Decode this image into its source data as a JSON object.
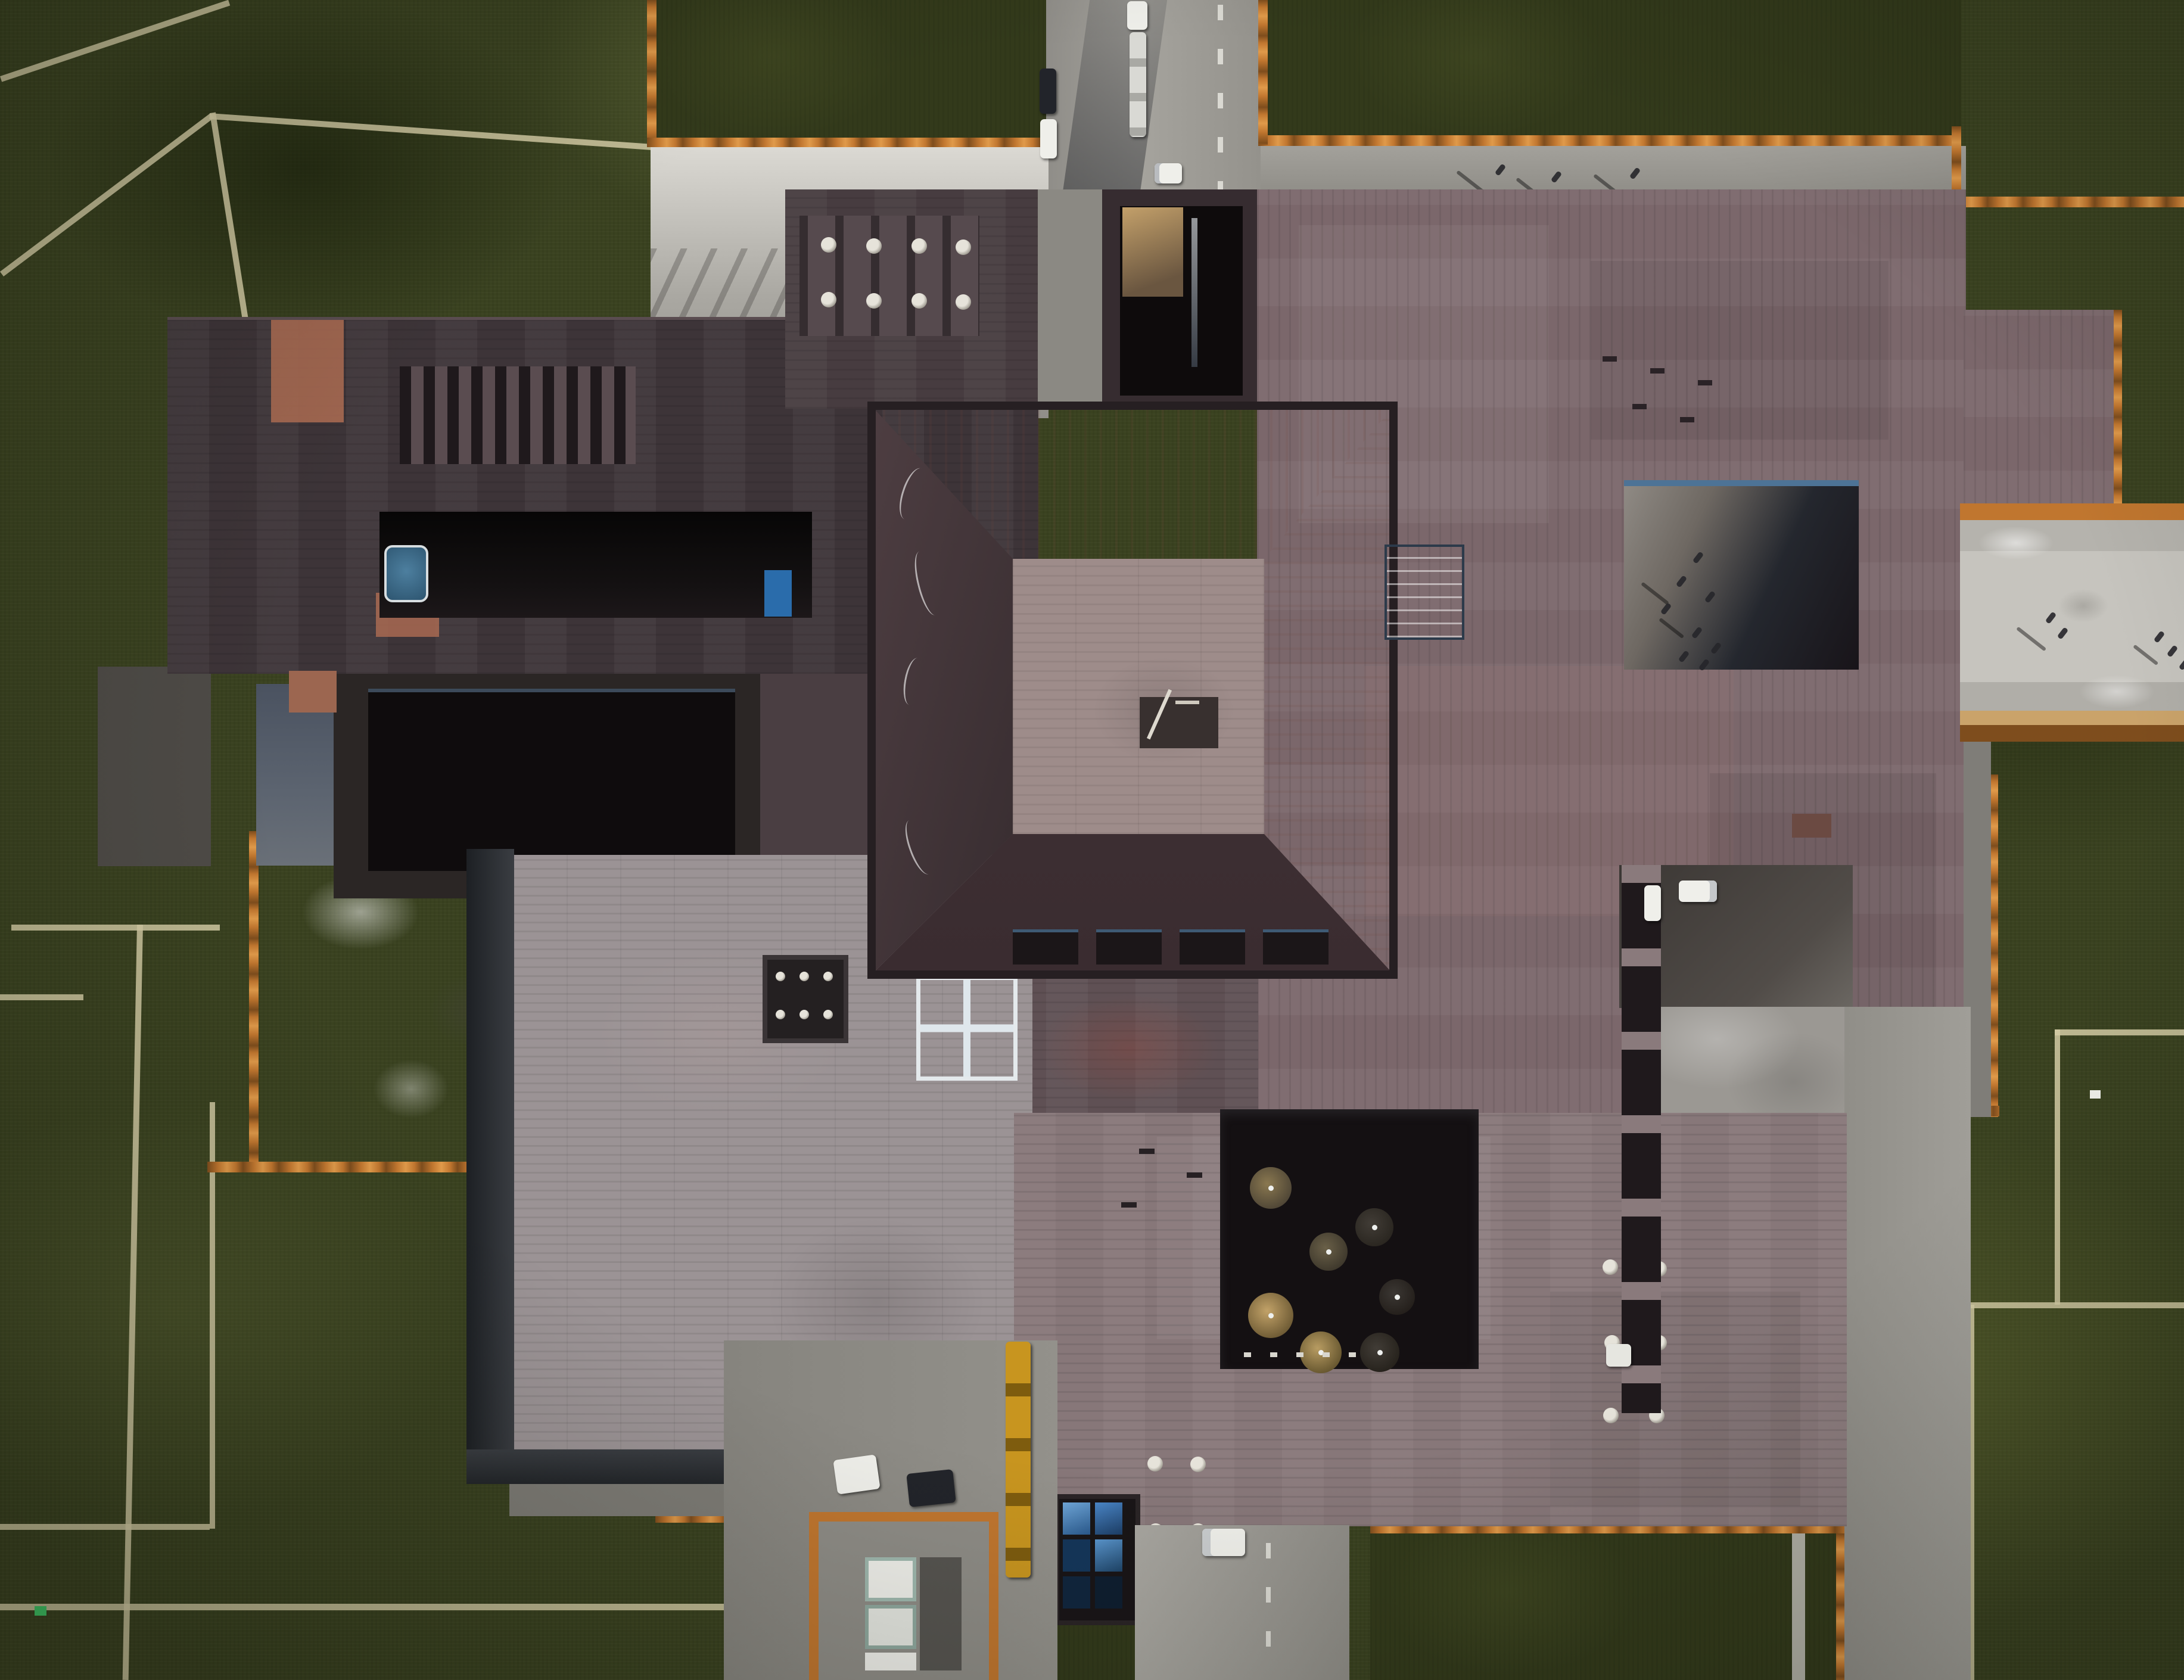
{
  "meta": {
    "description": "Top-down aerial drone photograph of a large museum-style building complex under afternoon light with long shadows",
    "view": "nadir (directly overhead)",
    "setting": "building complex surrounded by olive-green lawns divided by pale paths"
  },
  "palette": {
    "grass": "#3a4220",
    "grassPlot": "#333a1b",
    "grassLine": "#d3cba4",
    "concrete": "#9b9893",
    "concreteLight": "#c9c7c0",
    "concreteWeathered": "#dbd9d3",
    "concreteShadow": "#4e4b47",
    "concreteDark": "#7d7b75",
    "rust": "#c0762f",
    "rustLight": "#e09a4a",
    "rustDark": "#7e4d1d",
    "wing": "#3d3438",
    "wingLight": "#5a4c50",
    "slotDark": "#1f191c",
    "blockA": "#473c40",
    "blockB": "#362c30",
    "roofMain": "#7b676b",
    "roofGray": "#9b9395",
    "roofGray2": "#877779",
    "roofBelow": "#5f5054",
    "pavTop": "#d2a497",
    "pavTopLight": "#e0b6a8",
    "pavRight": "#c2a49a",
    "pavLeft": "#4e3e42",
    "pavDark": "#443438",
    "pavFlat": "#9e8c8a",
    "frame": "#261f22",
    "skyBlue": "#3f8fd2",
    "skyBlueLight": "#85b9e4",
    "skyBlueDark": "#2a6cab",
    "courtDark": "#141012",
    "courtMid": "#2b2625",
    "treeTan": "#c2a268",
    "treeOlive": "#8a7850",
    "treeDark": "#413c36",
    "terracotta": "#a96a52",
    "terracottaDark": "#8a5c50",
    "white": "#efefea",
    "carDark": "#22242a",
    "truckYellow": "#c8951f",
    "person": "#26262a",
    "steelBlue": "#5c6470",
    "poolBlack": "#0f0c0d",
    "litWall": "#c3a06a",
    "signGreen": "#3ec264"
  },
  "scene": {
    "building": {
      "central_pavilion": "square hipped roof, salmon-pink sunlit north slope, dark shaded slopes, flat mauve center with small hatch opening, four dark skylights on south slope",
      "left_wing": "dark charcoal bar with row of slot windows, recessed black entrance strip, terracotta accent patches",
      "main_east_roof": "large mauve-brown roof with sunken light-well courtyard and vent marks",
      "south_roof": "gray-mauve roof with sunken tree courtyard, round vents and glazed skylight grid",
      "west_roof": "light gray plank-textured roof with dark skylight box and blue glazed skylight"
    },
    "skylights_blue": 3,
    "courtyard_trees": 7,
    "orange_curbs": "weathered corten-steel edging around lawns and roof plots",
    "vehicles": [
      {
        "kind": "dark-car",
        "location": "north road"
      },
      {
        "kind": "white-car",
        "location": "north road"
      },
      {
        "kind": "white-car",
        "location": "north road moving"
      },
      {
        "kind": "white-truck-with-trailer",
        "location": "north road"
      },
      {
        "kind": "white-car",
        "location": "east parking nook"
      },
      {
        "kind": "white-car",
        "location": "east parking nook"
      },
      {
        "kind": "white-car",
        "location": "south plaza"
      },
      {
        "kind": "dark-car",
        "location": "south plaza"
      },
      {
        "kind": "yellow-articulated-truck",
        "location": "south plaza"
      },
      {
        "kind": "white-van",
        "location": "south road"
      },
      {
        "kind": "white-car",
        "location": "south-east path"
      }
    ],
    "people_groups": [
      {
        "where": "north concrete band",
        "count": 3
      },
      {
        "where": "east light-well courtyard",
        "count": 8
      },
      {
        "where": "east walkway",
        "count": 5
      }
    ],
    "equipment": "HVAC units inside orange-edged enclosure at south-west corner",
    "markers": [
      {
        "kind": "green-sign",
        "location": "bottom-left lawn"
      },
      {
        "kind": "white-sign",
        "location": "bottom-right lawn"
      }
    ]
  }
}
